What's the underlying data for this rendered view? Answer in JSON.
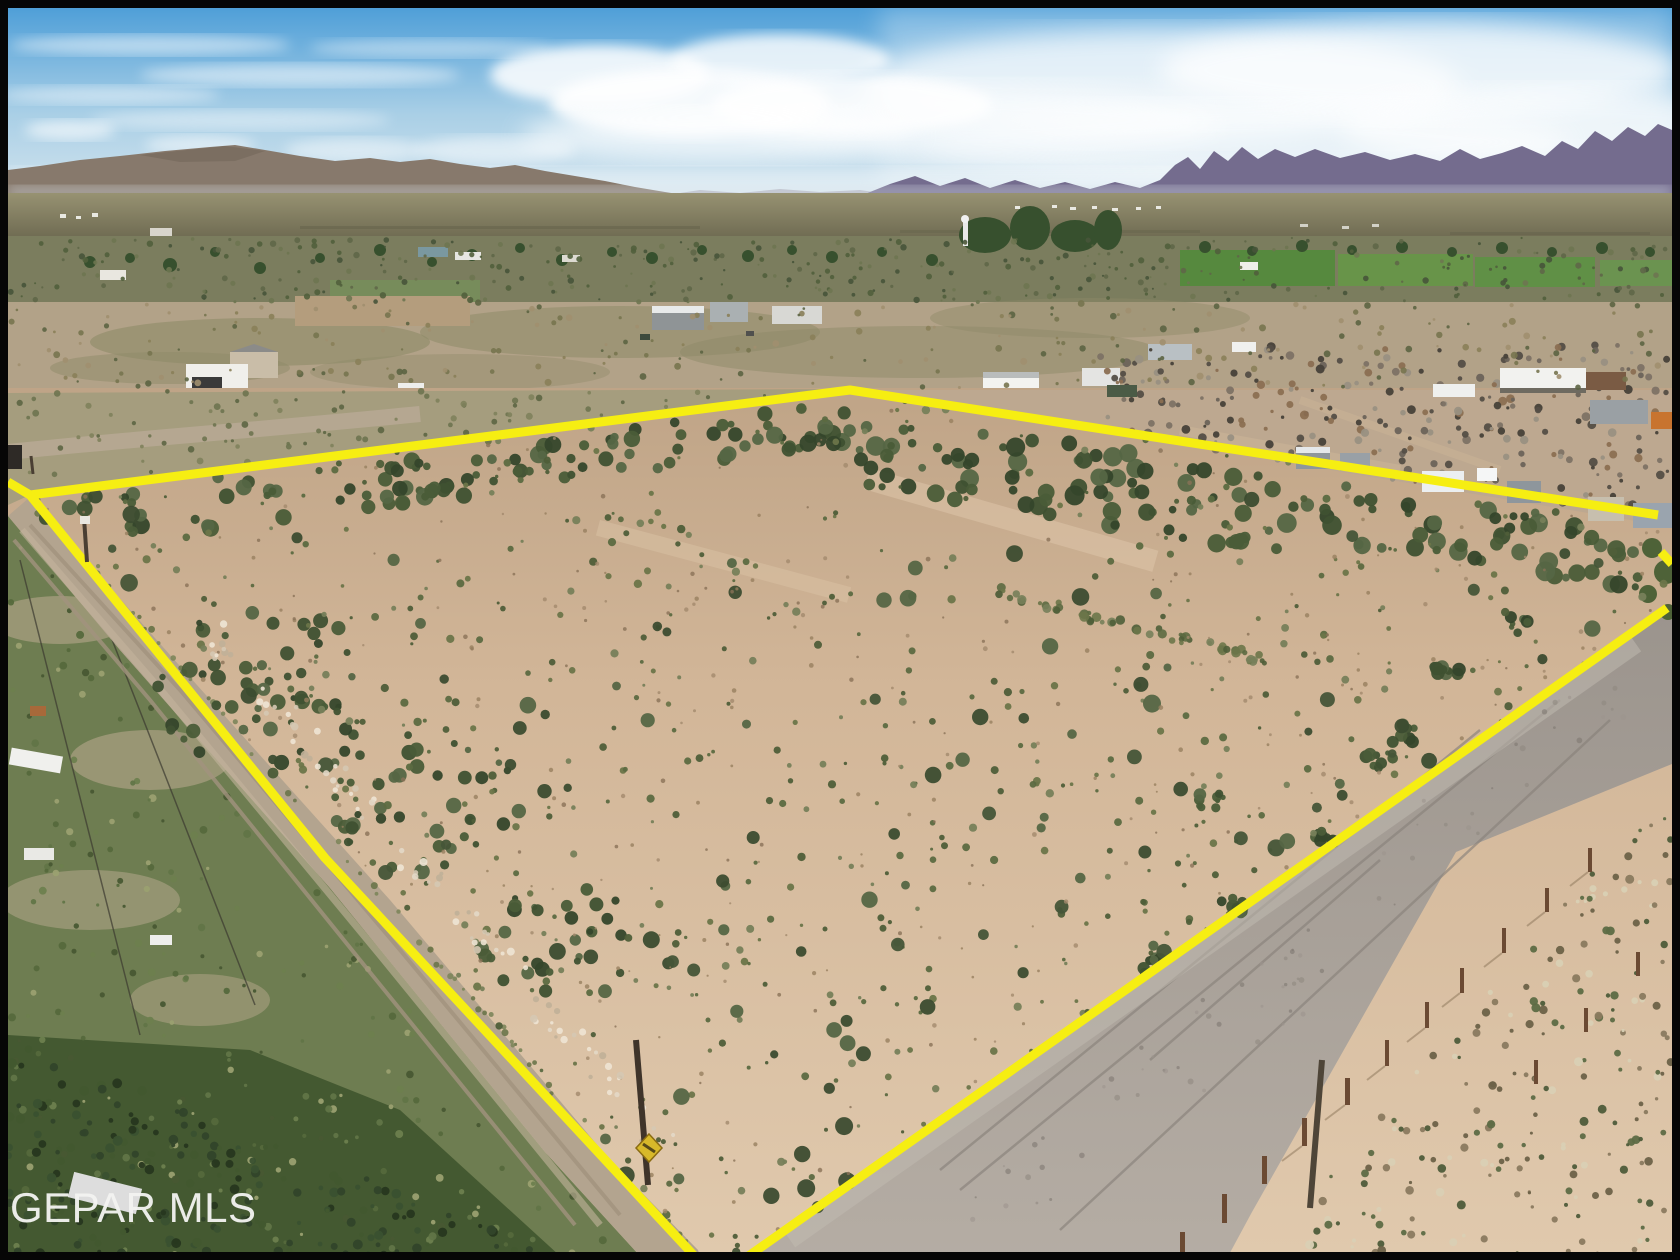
{
  "watermark": {
    "text": "GEPAR MLS"
  },
  "boundary": {
    "stroke_width": 9,
    "main_points": "8,482 30,495 850,390 1658,515",
    "left_points": "30,495 325,858 700,1262",
    "right_points": "1667,608 740,1262",
    "gap_dash_points": "1661,552 1672,564"
  },
  "warning_sign": {
    "shape": "diamond"
  },
  "colors": {
    "frame_black": "#060606",
    "sky_top": "#4f9fd8",
    "sky_mid": "#a9cfe6",
    "sky_horizon": "#d3e4ee",
    "cloud_white": "#ffffff",
    "mountain_left": "#87796c",
    "mountain_right": "#746c8e",
    "distant_plain": "#8b8669",
    "scrub_olive": "#7b7d5e",
    "field_green": "#56893e",
    "midground_tan": "#b2a288",
    "sand_light": "#dcc3a7",
    "sand_dark": "#c2a686",
    "shrub_green": "#546340",
    "hedge_green": "#3f5132",
    "dirt_road": "#b3a48f",
    "gravel_road": "#a8a19a",
    "yard_green": "#6e7d51",
    "brush_green": "#445931",
    "post_brown": "#6b4a33",
    "boundary_yellow": "#f6ee12",
    "sign_yellow": "#d8b92a",
    "watermark_white": "#f4f4f2"
  }
}
